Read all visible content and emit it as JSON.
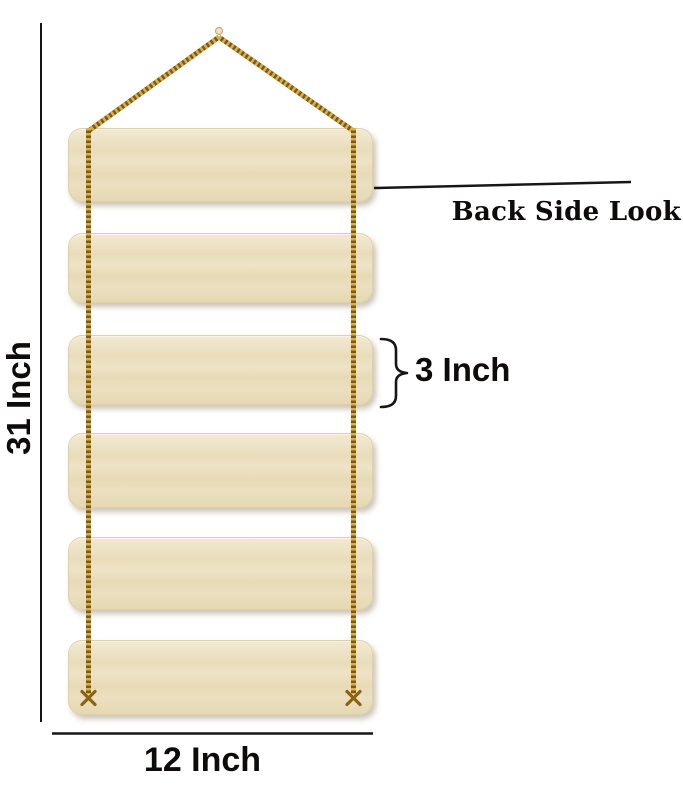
{
  "diagram": {
    "caption": "Back Side Look",
    "dim_height": "31 Inch",
    "dim_width": "12 Inch",
    "dim_plank": "3 Inch",
    "plank_count": 6,
    "colors": {
      "plank_base": "#ece1c4",
      "plank_light": "#f2e9d0",
      "plank_dark": "#e5d8b2",
      "rope_base": "#7a5a18",
      "rope_highlight": "#dcaf48",
      "knot": "#8a6413",
      "nail_fill": "#efe3c4",
      "nail_stroke": "#bfae85",
      "line": "#161616"
    }
  }
}
